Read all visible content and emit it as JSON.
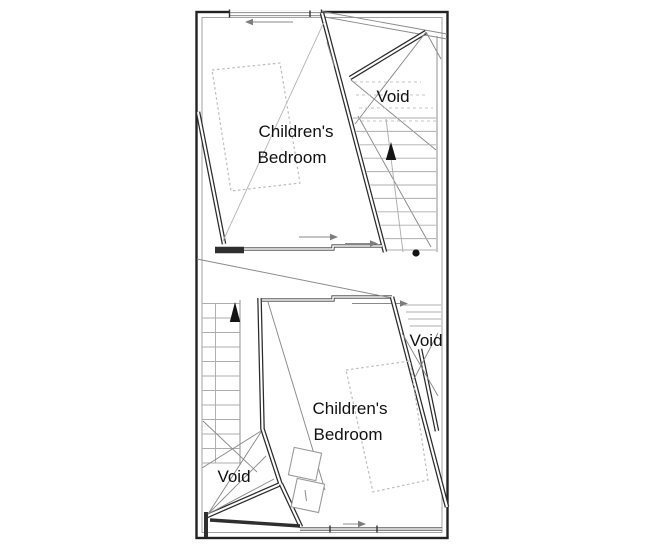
{
  "figure": {
    "kind": "architectural-floor-plan",
    "background_color": "#ffffff",
    "wall_color": "#2b2b2b",
    "thin_line_color": "#8a8a8a",
    "dashed_line_color": "#c4c4c4",
    "text_color": "#111111"
  },
  "labels": {
    "bedroom_top_line1": "Children's",
    "bedroom_top_line2": "Bedroom",
    "bedroom_bottom_line1": "Children's",
    "bedroom_bottom_line2": "Bedroom",
    "void_top_right": "Void",
    "void_mid_right": "Void",
    "void_bottom_left": "Void"
  }
}
